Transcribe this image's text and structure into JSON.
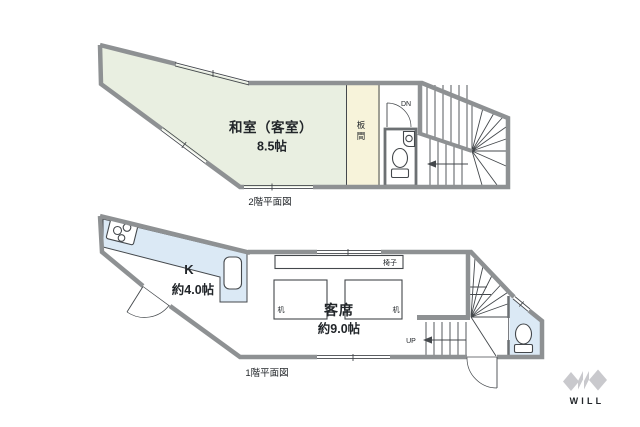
{
  "colors": {
    "tatami": "#e9efe1",
    "itama": "#f7f3da",
    "water": "#dbe9f5",
    "wall": "#8e9193",
    "line": "#44484c",
    "logo": "#c9c9cd"
  },
  "floor2": {
    "caption": "2階平面図",
    "room_name": "和室（客室）",
    "room_size": "8.5帖",
    "itama_top": "板",
    "itama_bottom": "間",
    "stair_label": "DN"
  },
  "floor1": {
    "caption": "1階平面図",
    "kitchen_label": "K",
    "kitchen_size": "約4.0帖",
    "dining_label": "客席",
    "dining_size": "約9.0帖",
    "bench_label": "椅子",
    "table_left": "机",
    "table_right": "机",
    "stair_label": "UP"
  },
  "logo": {
    "text": "WILL"
  }
}
